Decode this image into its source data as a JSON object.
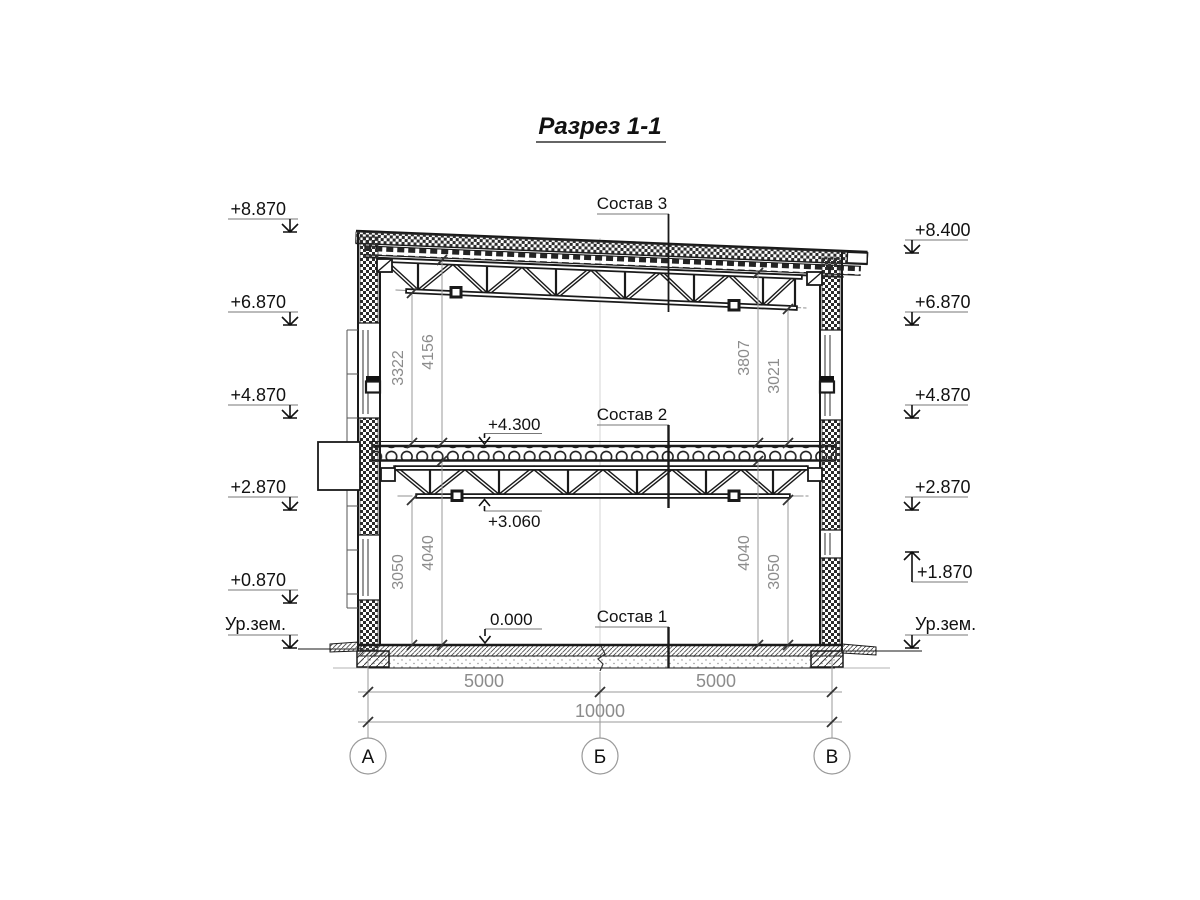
{
  "title": "Разрез 1-1",
  "elevations_left": [
    "+8.870",
    "+6.870",
    "+4.870",
    "+2.870",
    "+0.870",
    "Ур.зем."
  ],
  "elevations_right": [
    "+8.400",
    "+6.870",
    "+4.870",
    "+2.870",
    "+1.870",
    "Ур.зем."
  ],
  "level_marks": {
    "floor2_top": "+4.300",
    "truss2_bottom": "+3.060",
    "floor1_top": "0.000"
  },
  "callouts": {
    "roof": "Состав 3",
    "floor2": "Состав 2",
    "floor1": "Состав 1"
  },
  "dims_vertical": {
    "upper_left": [
      "3322",
      "4156"
    ],
    "upper_right": [
      "3807",
      "3021"
    ],
    "lower_left": [
      "3050",
      "4040"
    ],
    "lower_right": [
      "4040",
      "3050"
    ]
  },
  "dims_horizontal": {
    "spans": [
      "5000",
      "5000"
    ],
    "total": "10000"
  },
  "axes": [
    "А",
    "Б",
    "В"
  ],
  "colors": {
    "line": "#1a1a1a",
    "dim": "#8c8c8c"
  }
}
